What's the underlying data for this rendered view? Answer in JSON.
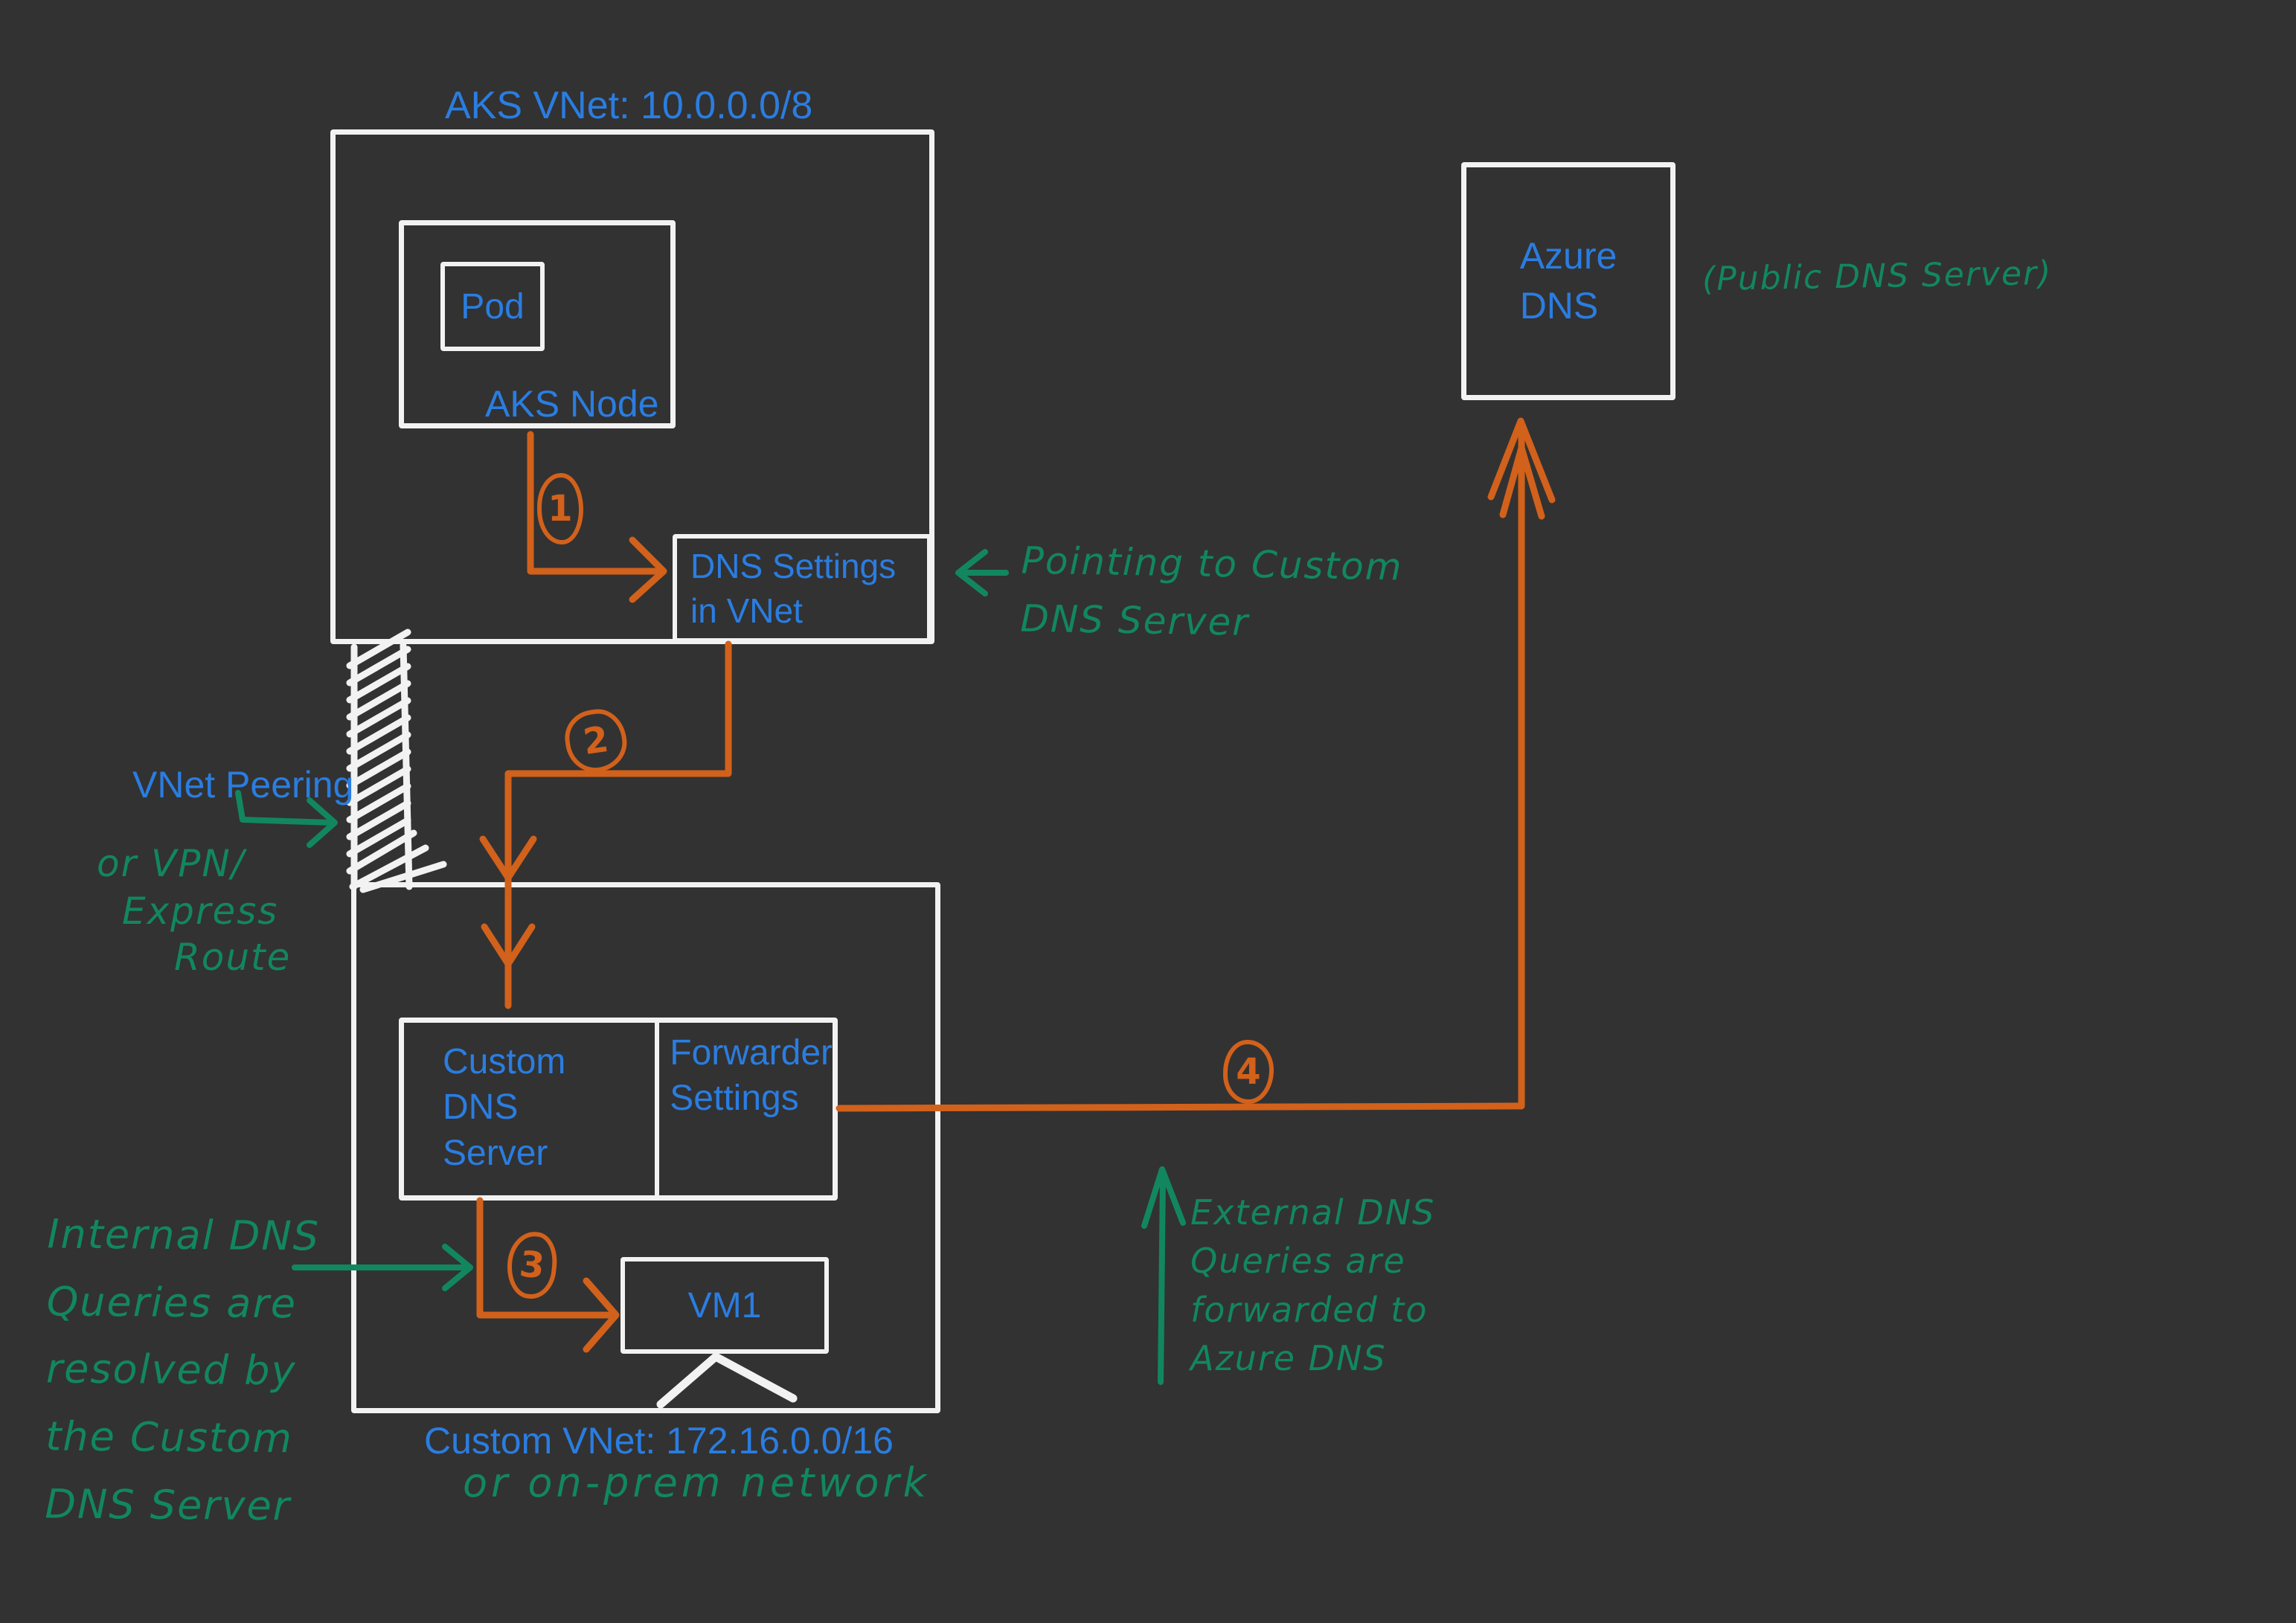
{
  "colors": {
    "background": "#323232",
    "label_blue": "#2a7de1",
    "annotation_green": "#12875f",
    "flow_orange": "#d2611b",
    "box_stroke": "#f2f2f2"
  },
  "aks_vnet": {
    "title": "AKS VNet: 10.0.0.0/8",
    "node_label": "AKS Node",
    "pod_label": "Pod",
    "dns_settings_label": "DNS Settings\nin VNet"
  },
  "azure_dns": {
    "label": "Azure\nDNS",
    "annotation": "(Public DNS Server)"
  },
  "custom_vnet": {
    "title": "Custom VNet: 172.16.0.0/16",
    "alt_note": "or on-prem network",
    "dns_server_label": "Custom\nDNS\nServer",
    "forwarder_label": "Forwarder\nSettings",
    "vm_label": "VM1"
  },
  "peering": {
    "label": "VNet Peering",
    "alt_lines": [
      "or VPN/",
      "Express",
      "Route"
    ]
  },
  "notes": {
    "pointing": "Pointing to Custom\nDNS Server",
    "internal": "Internal DNS\nQueries are\nresolved by\nthe Custom\nDNS Server",
    "external": "External DNS\nQueries are\nforwarded to\nAzure DNS"
  },
  "steps": {
    "one": "1",
    "two": "2",
    "three": "3",
    "four": "4"
  }
}
